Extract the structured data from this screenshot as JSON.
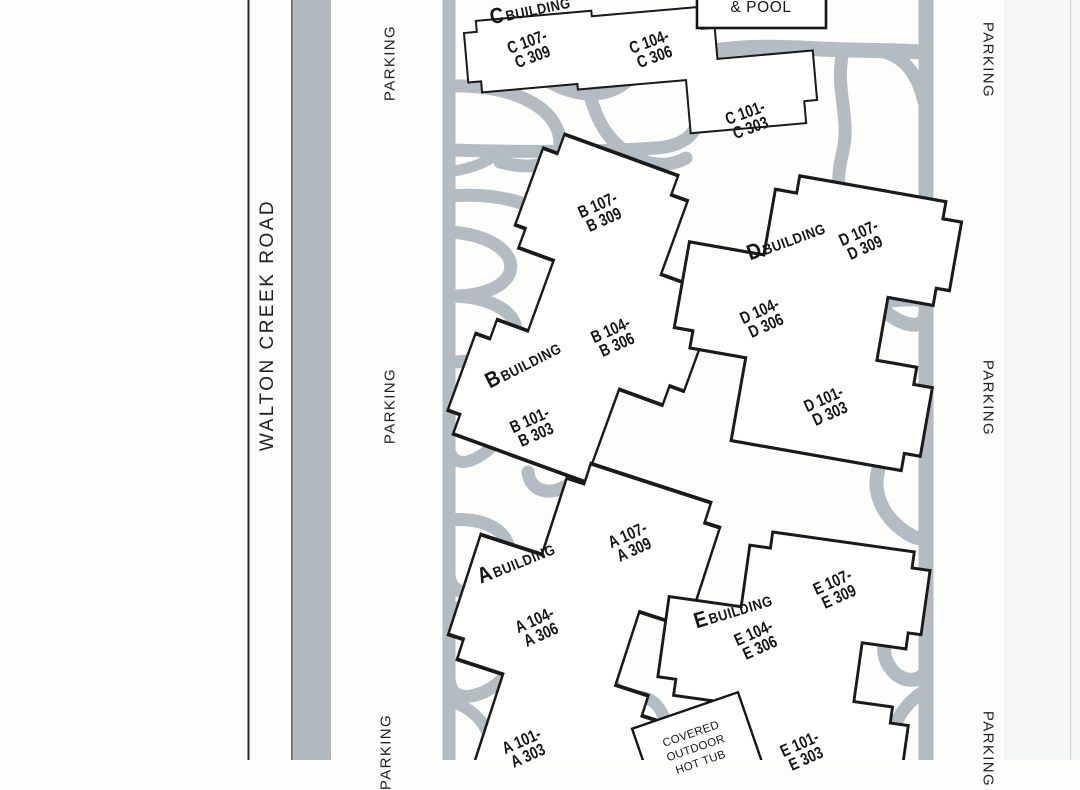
{
  "road_label": "WALTON CREEK ROAD",
  "parking_label": "PARKING",
  "amenities": {
    "pool_box_label": "& POOL",
    "hot_tub_lines": [
      "COVERED",
      "OUTDOOR",
      "HOT TUB"
    ]
  },
  "buildings": [
    {
      "id": "C",
      "initial": "C",
      "name": "BUILDING",
      "units": [
        [
          "C 107-",
          "C 309"
        ],
        [
          "C 104-",
          "C 306"
        ],
        [
          "C 101-",
          "C 303"
        ]
      ]
    },
    {
      "id": "B",
      "initial": "B",
      "name": "BUILDING",
      "units": [
        [
          "B 107-",
          "B 309"
        ],
        [
          "B 104-",
          "B 306"
        ],
        [
          "B 101-",
          "B 303"
        ]
      ]
    },
    {
      "id": "D",
      "initial": "D",
      "name": "BUILDING",
      "units": [
        [
          "D 107-",
          "D 309"
        ],
        [
          "D 104-",
          "D 306"
        ],
        [
          "D 101-",
          "D 303"
        ]
      ]
    },
    {
      "id": "A",
      "initial": "A",
      "name": "BUILDING",
      "units": [
        [
          "A 107-",
          "A 309"
        ],
        [
          "A 104-",
          "A 306"
        ],
        [
          "A 101-",
          "A 303"
        ]
      ]
    },
    {
      "id": "E",
      "initial": "E",
      "name": "BUILDING",
      "units": [
        [
          "E 107-",
          "E 309"
        ],
        [
          "E 104-",
          "E 306"
        ],
        [
          "E 101-",
          "E 303"
        ]
      ]
    }
  ],
  "colors": {
    "walkway_gray": "#b4bcc3",
    "road_gray": "#b1b9c0",
    "outline_black": "#1a1a1a"
  }
}
